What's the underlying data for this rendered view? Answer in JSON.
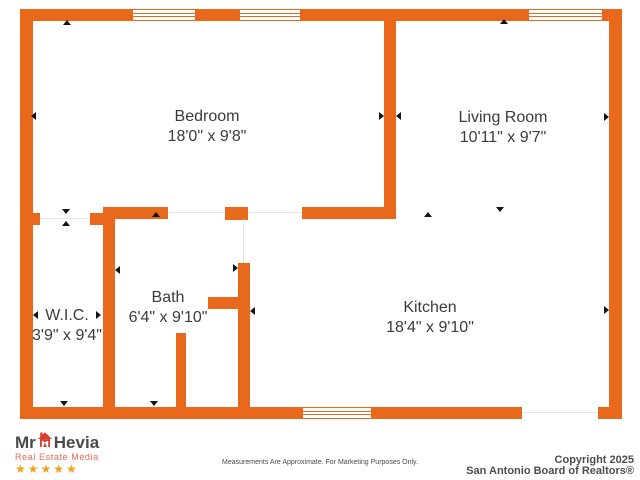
{
  "document": {
    "type": "residential-floor-plan"
  },
  "rooms": [
    {
      "name": "Bedroom",
      "dimensions": "18'0\" x 9'8\""
    },
    {
      "name": "Living Room",
      "dimensions": "10'11\" x 9'7\""
    },
    {
      "name": "W.I.C.",
      "dimensions": "3'9\" x 9'4\""
    },
    {
      "name": "Bath",
      "dimensions": "6'4\" x 9'10\""
    },
    {
      "name": "Kitchen",
      "dimensions": "18'4\" x 9'10\""
    }
  ],
  "branding": {
    "logo_prefix": "Mr",
    "logo_name": "Hevia",
    "logo_subtitle": "Real Estate Media",
    "stars": "★★★★★"
  },
  "footer": {
    "disclaimer": "Measurements Are Approximate. For Marketing Purposes Only.",
    "copyright_line1": "Copyright 2025",
    "copyright_line2": "San Antonio Board of Realtors®"
  },
  "icons": {
    "house_logo_icon": "house-with-person",
    "star_icon": "star"
  },
  "colors": {
    "wall_orange": "#E8691C",
    "label_text": "#3B3B3B",
    "logo_text": "#4A4A4A",
    "logo_red": "#D6402E",
    "logo_subtitle_red": "#EC6A50",
    "star_gold": "#F2A11C",
    "copyright_gray": "#4D4D4D"
  }
}
